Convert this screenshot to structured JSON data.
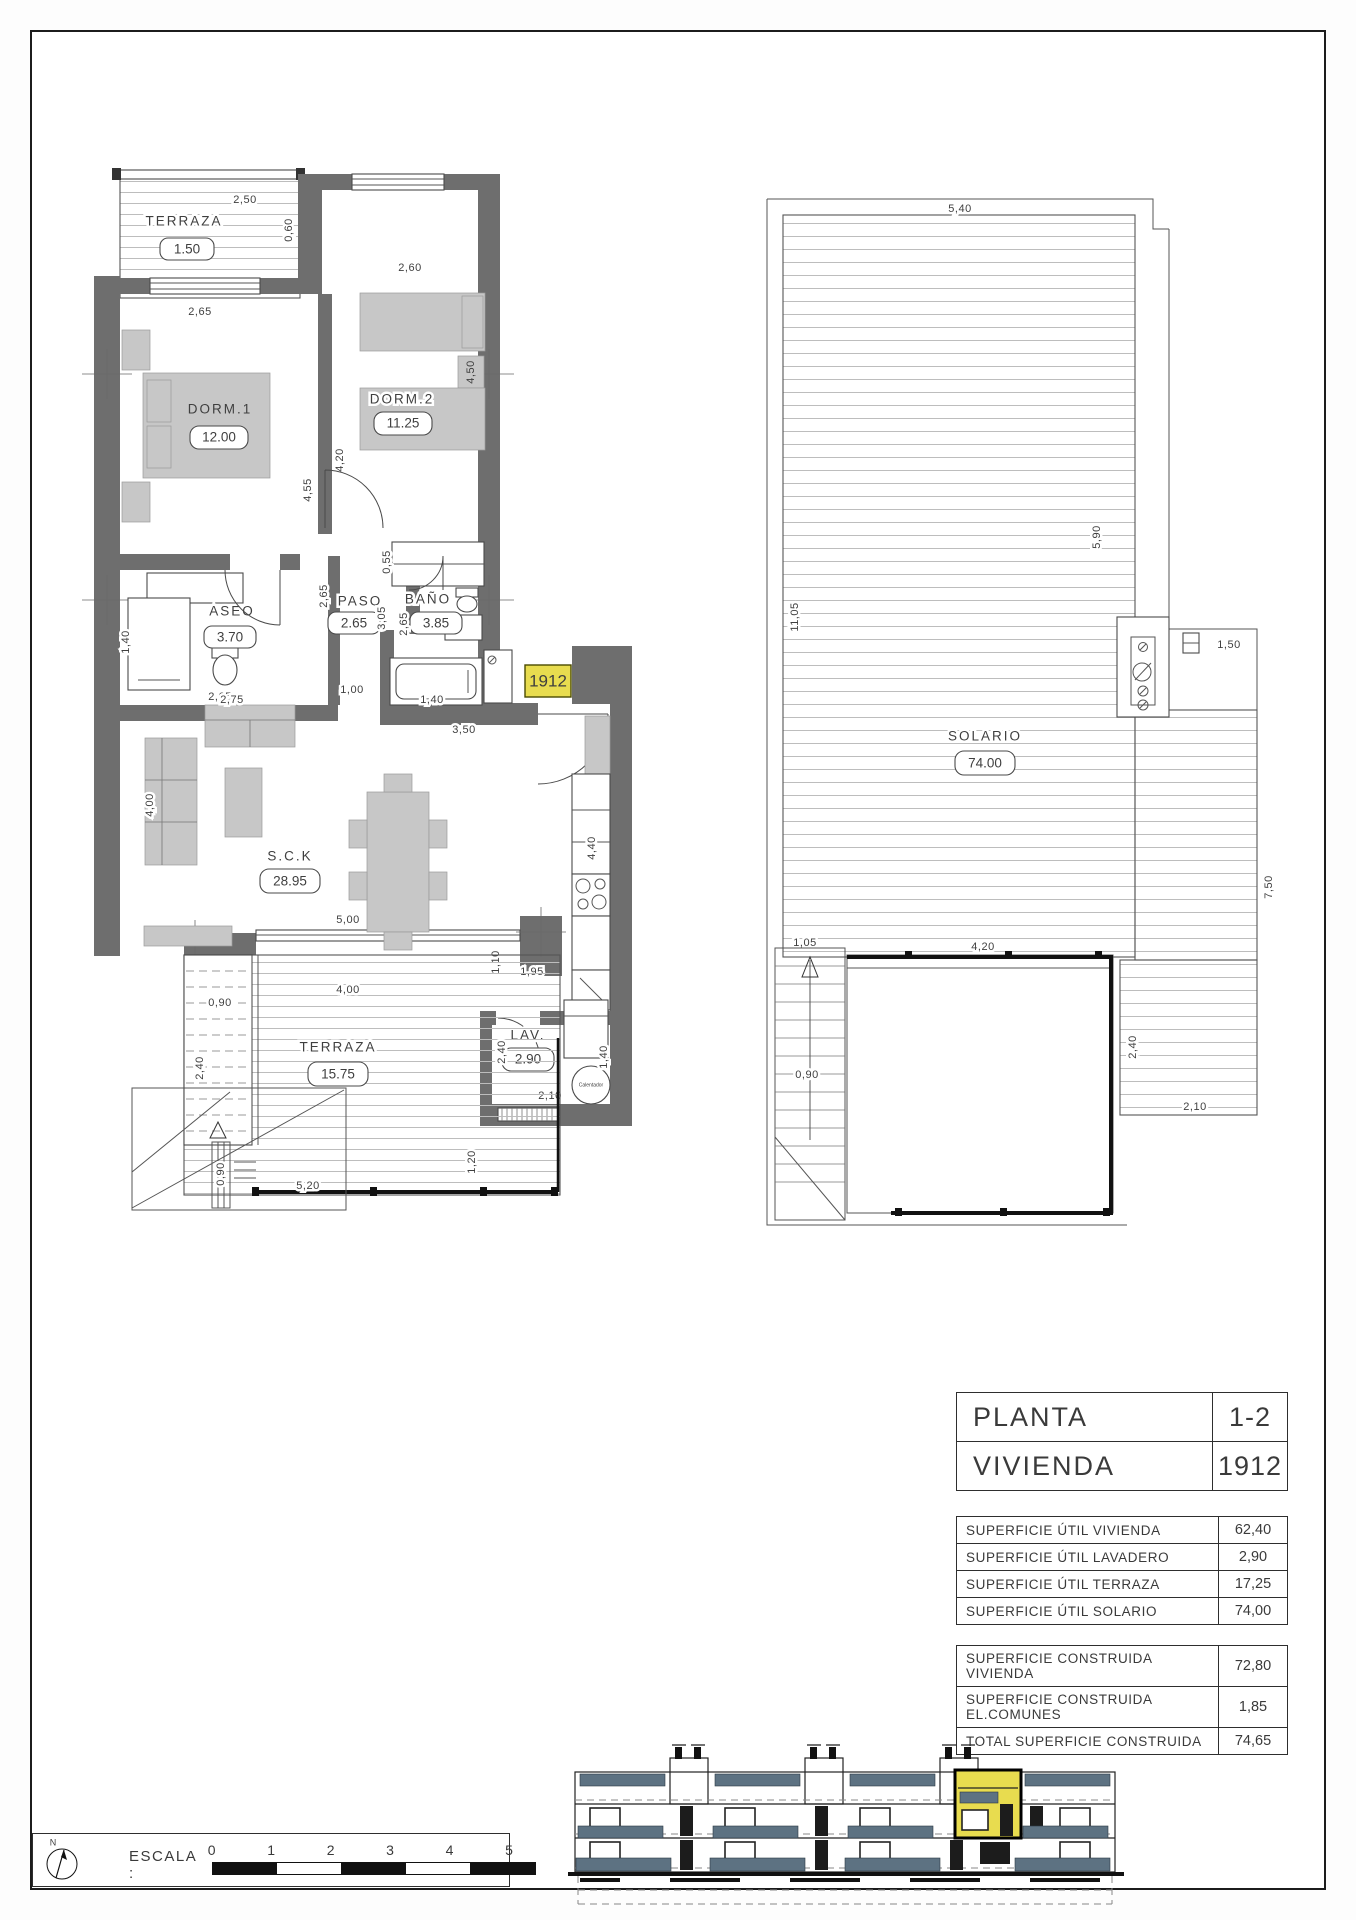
{
  "colors": {
    "wall": "#6e6e6e",
    "furn": "#c7c7c7",
    "hatch": "#bdbdbd",
    "highlight": "#e8dc4f",
    "balcony": "#5d7282",
    "text": "#3f3f3f"
  },
  "plan1": {
    "rooms": {
      "terraza_sup": {
        "name": "TERRAZA",
        "area": "1.50"
      },
      "dorm1": {
        "name": "DORM.1",
        "area": "12.00"
      },
      "dorm2": {
        "name": "DORM.2",
        "area": "11.25"
      },
      "aseo": {
        "name": "ASEO",
        "area": "3.70"
      },
      "paso": {
        "name": "PASO",
        "area": "2.65"
      },
      "bano": {
        "name": "BAÑO",
        "area": "3.85"
      },
      "sck": {
        "name": "S.C.K",
        "area": "28.95"
      },
      "terraza_inf": {
        "name": "TERRAZA",
        "area": "15.75"
      },
      "lav": {
        "name": "LAV.",
        "area": "2.90"
      }
    },
    "dims": {
      "d250": "2,50",
      "d060": "0,60",
      "d265a": "2,65",
      "d260": "2,60",
      "d455": "4,55",
      "d420": "4,20",
      "d450": "4,50",
      "d055": "0,55",
      "d140a": "1,40",
      "d265b": "2,65",
      "d275": "2,75",
      "d265c": "2,65",
      "d305": "3,05",
      "d265d": "2,65",
      "d100": "1,00",
      "d140b": "1,40",
      "d350": "3,50",
      "d400a": "4,00",
      "d500": "5,00",
      "d400b": "4,00",
      "d090a": "0,90",
      "d240a": "2,40",
      "d240b": "2,40",
      "d440": "4,40",
      "d195": "1,95",
      "d110": "1,10",
      "d140c": "1,40",
      "d210": "2,10",
      "d120": "1,20",
      "d090b": "0,90",
      "d520": "5,20"
    },
    "unit_tag": "1912",
    "calentador": "Calentador"
  },
  "plan2": {
    "room": {
      "name": "SOLARIO",
      "area": "74.00"
    },
    "dims": {
      "d540": "5,40",
      "d590": "5,90",
      "d1105": "11,05",
      "d150": "1,50",
      "d750": "7,50",
      "d105": "1,05",
      "d420": "4,20",
      "d240": "2,40",
      "d090": "0,90",
      "d210": "2,10"
    }
  },
  "info": {
    "header": [
      {
        "label": "PLANTA",
        "value": "1-2"
      },
      {
        "label": "VIVIENDA",
        "value": "1912"
      }
    ],
    "util": [
      {
        "label": "SUPERFICIE ÚTIL VIVIENDA",
        "value": "62,40"
      },
      {
        "label": "SUPERFICIE ÚTIL LAVADERO",
        "value": "2,90"
      },
      {
        "label": "SUPERFICIE ÚTIL TERRAZA",
        "value": "17,25"
      },
      {
        "label": "SUPERFICIE ÚTIL SOLARIO",
        "value": "74,00"
      }
    ],
    "construida": [
      {
        "label": "SUPERFICIE CONSTRUIDA VIVIENDA",
        "value": "72,80"
      },
      {
        "label": "SUPERFICIE CONSTRUIDA EL.COMUNES",
        "value": "1,85"
      },
      {
        "label": "TOTAL SUPERFICIE CONSTRUIDA",
        "value": "74,65"
      }
    ]
  },
  "scalebar": {
    "label": "ESCALA :",
    "ticks": [
      "0",
      "1",
      "2",
      "3",
      "4",
      "5"
    ],
    "north": "N"
  }
}
